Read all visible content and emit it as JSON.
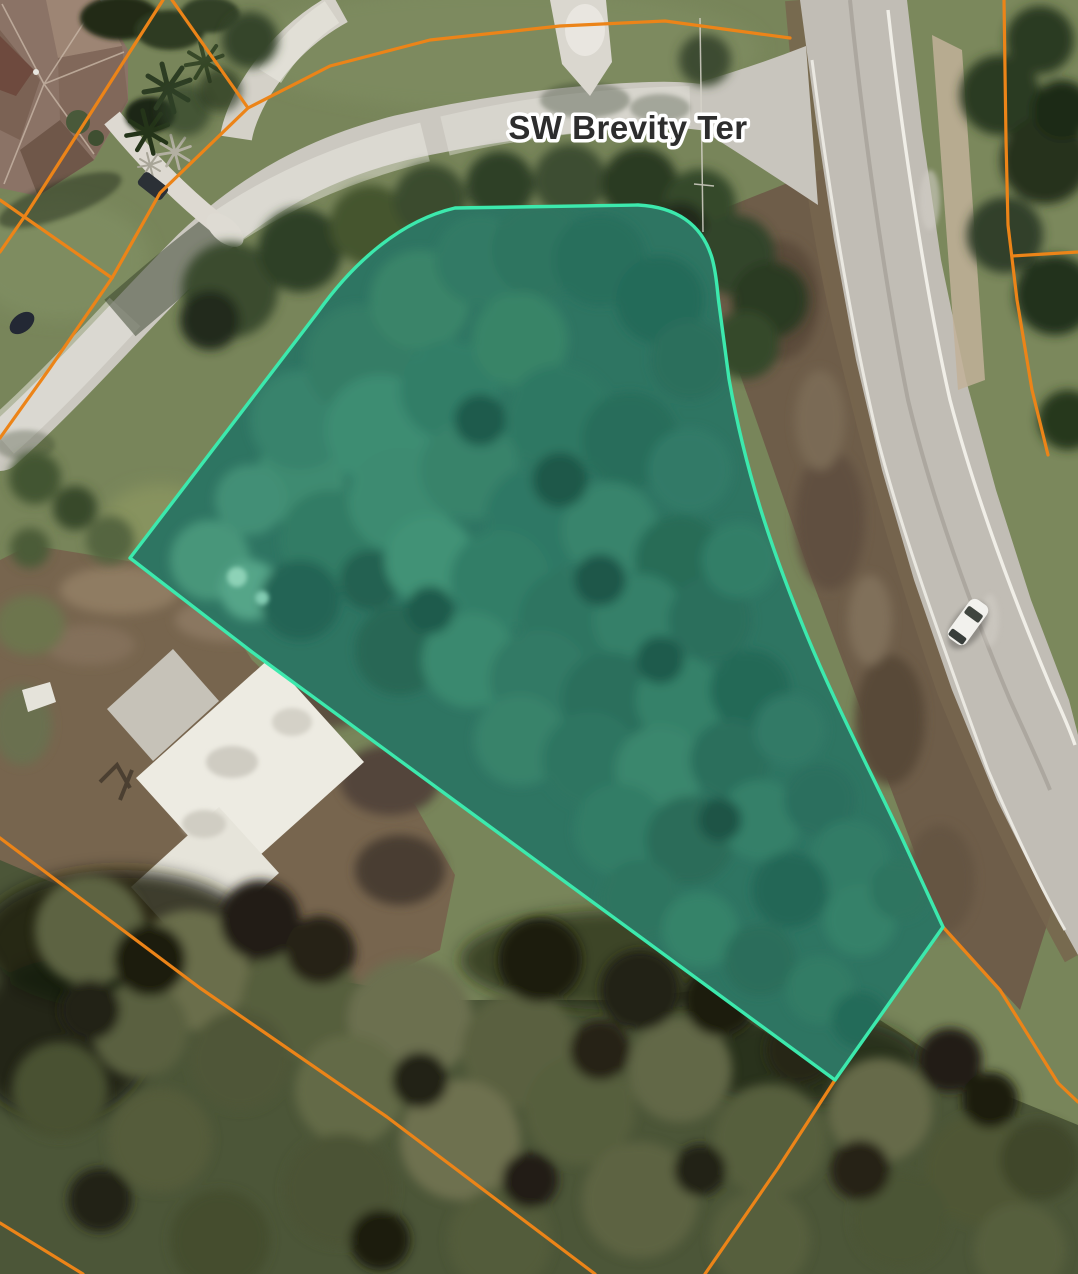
{
  "map": {
    "street_label": "SW Brevity Ter",
    "colors": {
      "parcel_stroke": "#3ce9ad",
      "parcel_fill": "rgba(70,225,188,0.17)",
      "lot_line": "#ec8418",
      "label_fill": "#2d2d2d",
      "label_halo": "#ffffff"
    },
    "parcel": {
      "path": "M130,558 L318,312 C348,270 395,222 455,208 L638,205 C676,207 702,224 712,258 C717,276 717,290 719,304 L729,379 C745,470 771,547 801,621 C831,696 866,762 901,836 L943,927 L835,1080 L598,906 L252,652 Z"
    },
    "lot_lines": [
      {
        "id": "nw-a",
        "points": "163,0 27,213 0,252"
      },
      {
        "id": "nw-b",
        "points": "172,0 248,108 160,193 112,278"
      },
      {
        "id": "street-north",
        "points": "248,108 330,66 430,40 560,26 665,21 790,38"
      },
      {
        "id": "west-a",
        "points": "112,278 0,200"
      },
      {
        "id": "west-b",
        "points": "112,278 50,368 0,438"
      },
      {
        "id": "south-a",
        "points": "0,838 200,988 387,1117 595,1274"
      },
      {
        "id": "south-corner",
        "points": "0,1223 83,1274"
      },
      {
        "id": "tip-south",
        "points": "835,1080 778,1168 705,1274"
      },
      {
        "id": "se",
        "points": "943,927 1000,990 1058,1083 1078,1102"
      },
      {
        "id": "east-a",
        "points": "1004,0 1006,140 1008,225 1017,300 1032,390 1048,455"
      },
      {
        "id": "east-b",
        "points": "1012,256 1078,252"
      }
    ]
  }
}
